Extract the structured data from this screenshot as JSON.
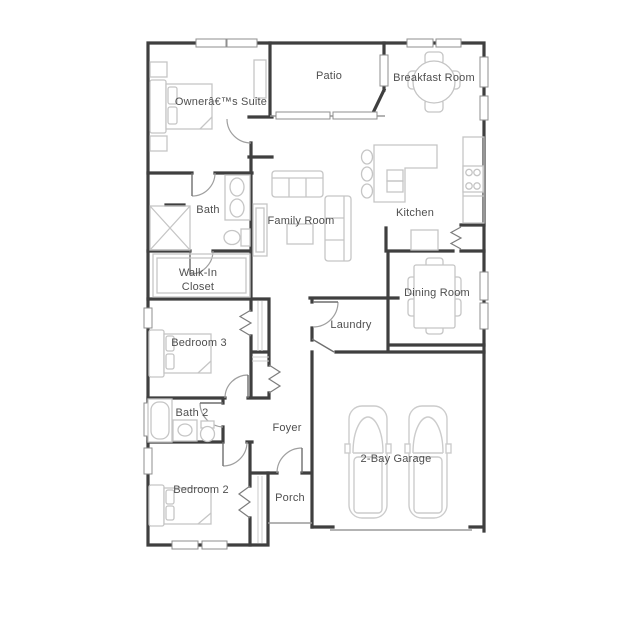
{
  "page": {
    "type": "floor-plan",
    "background": "#ffffff"
  },
  "colors": {
    "wall": "#3f3f3f",
    "window_outline": "#8f8f8f",
    "door_arc": "#9f9f9f",
    "furniture": "#c5c5c5",
    "label_text": "#4f4f4f"
  },
  "rooms": {
    "owners_suite": {
      "label": "Ownerâ€™s Suite"
    },
    "patio": {
      "label": "Patio"
    },
    "breakfast_room": {
      "label": "Breakfast Room"
    },
    "bath": {
      "label": "Bath"
    },
    "family_room": {
      "label": "Family Room"
    },
    "kitchen": {
      "label": "Kitchen"
    },
    "walk_in_closet": {
      "label_line1": "Walk-In",
      "label_line2": "Closet"
    },
    "dining_room": {
      "label": "Dining Room"
    },
    "bedroom_3": {
      "label": "Bedroom 3"
    },
    "laundry": {
      "label": "Laundry"
    },
    "bath_2": {
      "label": "Bath 2"
    },
    "foyer": {
      "label": "Foyer"
    },
    "bedroom_2": {
      "label": "Bedroom 2"
    },
    "porch": {
      "label": "Porch"
    },
    "garage": {
      "label": "2-Bay Garage"
    }
  },
  "furniture_icons": [
    "bed-icon",
    "nightstand-icon",
    "dresser-icon",
    "shower-icon",
    "toilet-icon",
    "double-sink-vanity-icon",
    "sofa-icon",
    "loveseat-icon",
    "coffee-table-icon",
    "tv-console-icon",
    "kitchen-island-icon",
    "bar-stool-icon",
    "range-icon",
    "counter-icon",
    "round-table-icon",
    "dining-table-icon",
    "chair-icon",
    "bathtub-icon",
    "sink-icon",
    "car-icon",
    "closet-rod-icon"
  ]
}
